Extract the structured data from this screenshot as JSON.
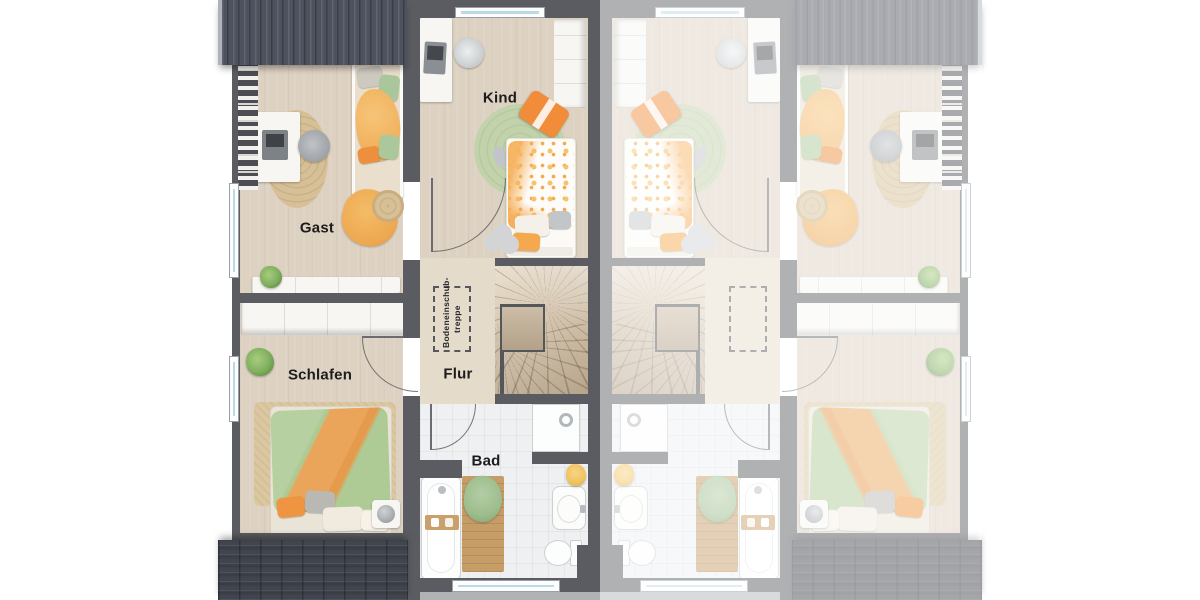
{
  "plan": {
    "rooms": {
      "gast": {
        "label": "Gast"
      },
      "kind": {
        "label": "Kind"
      },
      "schlafen": {
        "label": "Schlafen"
      },
      "flur": {
        "label": "Flur"
      },
      "bad": {
        "label": "Bad"
      }
    },
    "attic_hatch": {
      "label": "Bodeneinschub-treppe"
    },
    "units": {
      "left": "furnished colored unit",
      "right": "mirrored washed-out unit"
    }
  },
  "colors": {
    "wall": "#5a5c61",
    "wall_dark": "#4c4e54",
    "roof_top": "#4e525e",
    "roof_bottom": "#41454e",
    "floor_wood": "#ddd2c2",
    "floor_hall": "#e5dbcb",
    "floor_bath": "#eef0f2",
    "stairs_wood": "#d8c9b3",
    "glass_blue": "#bcd9ea",
    "furniture_white": "#f7f6f3",
    "rug_jute": "#d8c096",
    "rug_green": "#c2d3ab",
    "duvet_green": "#b7d0a2",
    "blanket_orange": "#eaa55b",
    "dot_orange": "#f5b45a",
    "towel_green": "#9dbd8d",
    "towel_yellow": "#f0c25c",
    "plant_green": "#7fae5e",
    "label_text": "#1c1c1c",
    "mirror_wash": "rgba(255,255,255,0.52)"
  }
}
